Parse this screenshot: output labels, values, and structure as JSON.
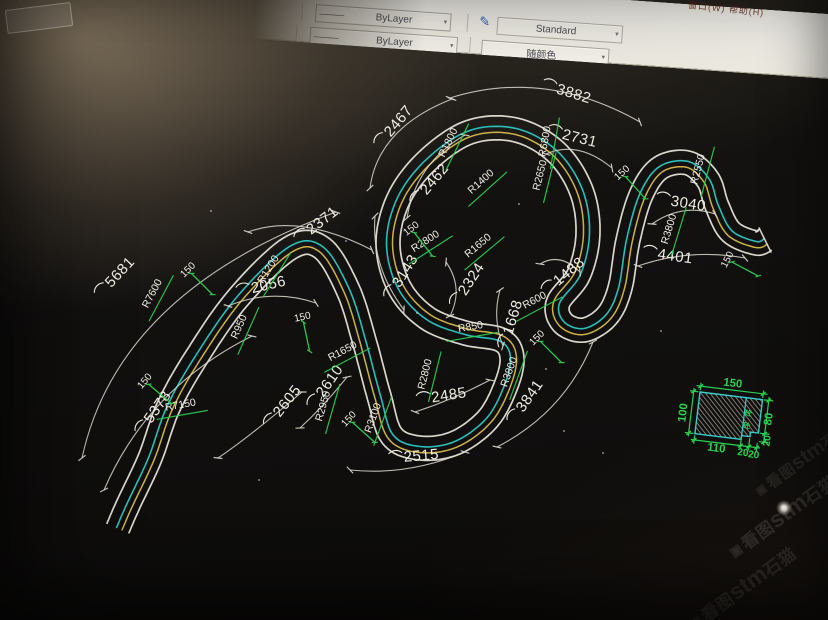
{
  "toolbar": {
    "linetype_value": "ByLayer",
    "linetype2_value": "ByLayer",
    "style_value": "Standard",
    "color_value": "随颜色",
    "line_glyph": "———",
    "arrow_glyph": "▾",
    "menu_right": "窗口(W) 帮助(H)"
  },
  "colors": {
    "band_white": "#eae7dc",
    "band_cyan": "#2bc8c3",
    "band_yellow": "#d9ba4a",
    "dim_green": "#2bd24f",
    "dim_line": "#ddd9cf",
    "dim_text": "#f0ede3",
    "detail_cyan": "#38cccc"
  },
  "drawing": {
    "arc_symbol": "⌒",
    "arc_dims": [
      {
        "id": "d5681",
        "text": "5681",
        "x": 118,
        "y": 281,
        "rot": -47
      },
      {
        "id": "d5378",
        "text": "5378",
        "x": 157,
        "y": 416,
        "rot": -55
      },
      {
        "id": "d2371",
        "text": "2371",
        "x": 319,
        "y": 229,
        "rot": -38
      },
      {
        "id": "d2056",
        "text": "2056",
        "x": 262,
        "y": 291,
        "rot": -13
      },
      {
        "id": "d2605",
        "text": "2605",
        "x": 286,
        "y": 410,
        "rot": -52
      },
      {
        "id": "d2610",
        "text": "2610",
        "x": 329,
        "y": 390,
        "rot": -55
      },
      {
        "id": "d2515",
        "text": "2515",
        "x": 414,
        "y": 461,
        "rot": -5
      },
      {
        "id": "d2485",
        "text": "2485",
        "x": 442,
        "y": 401,
        "rot": -9
      },
      {
        "id": "d3143",
        "text": "3143",
        "x": 405,
        "y": 280,
        "rot": -58
      },
      {
        "id": "d2467",
        "text": "2467",
        "x": 397,
        "y": 130,
        "rot": -50
      },
      {
        "id": "d2462",
        "text": "2462",
        "x": 433,
        "y": 188,
        "rot": -50
      },
      {
        "id": "d3882",
        "text": "3882",
        "x": 565,
        "y": 96,
        "rot": 17
      },
      {
        "id": "d2731",
        "text": "2731",
        "x": 571,
        "y": 141,
        "rot": 14
      },
      {
        "id": "d2324",
        "text": "2324",
        "x": 471,
        "y": 288,
        "rot": -57
      },
      {
        "id": "d1668",
        "text": "1668",
        "x": 515,
        "y": 326,
        "rot": -73
      },
      {
        "id": "d1488",
        "text": "1488",
        "x": 566,
        "y": 280,
        "rot": -40
      },
      {
        "id": "d3841",
        "text": "3841",
        "x": 529,
        "y": 405,
        "rot": -55
      },
      {
        "id": "d3040",
        "text": "3040",
        "x": 680,
        "y": 207,
        "rot": 9
      },
      {
        "id": "d4401",
        "text": "4401",
        "x": 667,
        "y": 260,
        "rot": 8
      }
    ],
    "radius_labels": [
      {
        "text": "R7600",
        "x": 155,
        "y": 295,
        "rot": -62
      },
      {
        "text": "R1200",
        "x": 271,
        "y": 271,
        "rot": -58
      },
      {
        "text": "R950",
        "x": 242,
        "y": 328,
        "rot": -66
      },
      {
        "text": "R7150",
        "x": 181,
        "y": 408,
        "rot": -10
      },
      {
        "text": "R1650",
        "x": 344,
        "y": 354,
        "rot": -28
      },
      {
        "text": "R2800",
        "x": 428,
        "y": 375,
        "rot": -76
      },
      {
        "text": "R2950",
        "x": 326,
        "y": 407,
        "rot": -74
      },
      {
        "text": "R3100",
        "x": 376,
        "y": 419,
        "rot": -70
      },
      {
        "text": "R850",
        "x": 471,
        "y": 330,
        "rot": -10
      },
      {
        "text": "R600",
        "x": 536,
        "y": 303,
        "rot": -28
      },
      {
        "text": "R3800",
        "x": 512,
        "y": 373,
        "rot": -70
      },
      {
        "text": "R1400",
        "x": 483,
        "y": 184,
        "rot": -42
      },
      {
        "text": "R1800",
        "x": 451,
        "y": 144,
        "rot": -64
      },
      {
        "text": "R2650",
        "x": 543,
        "y": 176,
        "rot": -76
      },
      {
        "text": "R2800",
        "x": 427,
        "y": 244,
        "rot": -33
      },
      {
        "text": "R1650",
        "x": 480,
        "y": 248,
        "rot": -40
      },
      {
        "text": "R6800",
        "x": 548,
        "y": 142,
        "rot": -80
      },
      {
        "text": "R2550",
        "x": 701,
        "y": 170,
        "rot": -75
      },
      {
        "text": "R3800",
        "x": 672,
        "y": 230,
        "rot": -73
      }
    ],
    "width_ticks": [
      {
        "text": "150",
        "x": 190,
        "y": 272,
        "rot": -45
      },
      {
        "text": "150",
        "x": 303,
        "y": 320,
        "rot": -12
      },
      {
        "text": "150",
        "x": 413,
        "y": 231,
        "rot": -38
      },
      {
        "text": "150",
        "x": 147,
        "y": 383,
        "rot": -50
      },
      {
        "text": "150",
        "x": 351,
        "y": 421,
        "rot": -48
      },
      {
        "text": "150",
        "x": 539,
        "y": 340,
        "rot": -45
      },
      {
        "text": "150",
        "x": 624,
        "y": 175,
        "rot": -42
      },
      {
        "text": "150",
        "x": 730,
        "y": 261,
        "rot": -62
      }
    ]
  },
  "detail": {
    "top_width": "150",
    "left_height": "100",
    "right_height": "80",
    "bottom_widths": [
      "110",
      "20",
      "20"
    ],
    "right_step": "20",
    "material_mark": "砼"
  },
  "watermark": {
    "logo_glyph": "▣",
    "prefix": "看图",
    "brand": "stm",
    "suffix": "石猫",
    "instances": [
      {
        "x": 788,
        "y": 516,
        "rot": -36,
        "size": 17,
        "opacity": 0.45
      },
      {
        "x": 748,
        "y": 588,
        "rot": -36,
        "size": 17,
        "opacity": 0.4
      },
      {
        "x": 816,
        "y": 462,
        "rot": -36,
        "size": 15,
        "opacity": 0.33
      }
    ]
  }
}
